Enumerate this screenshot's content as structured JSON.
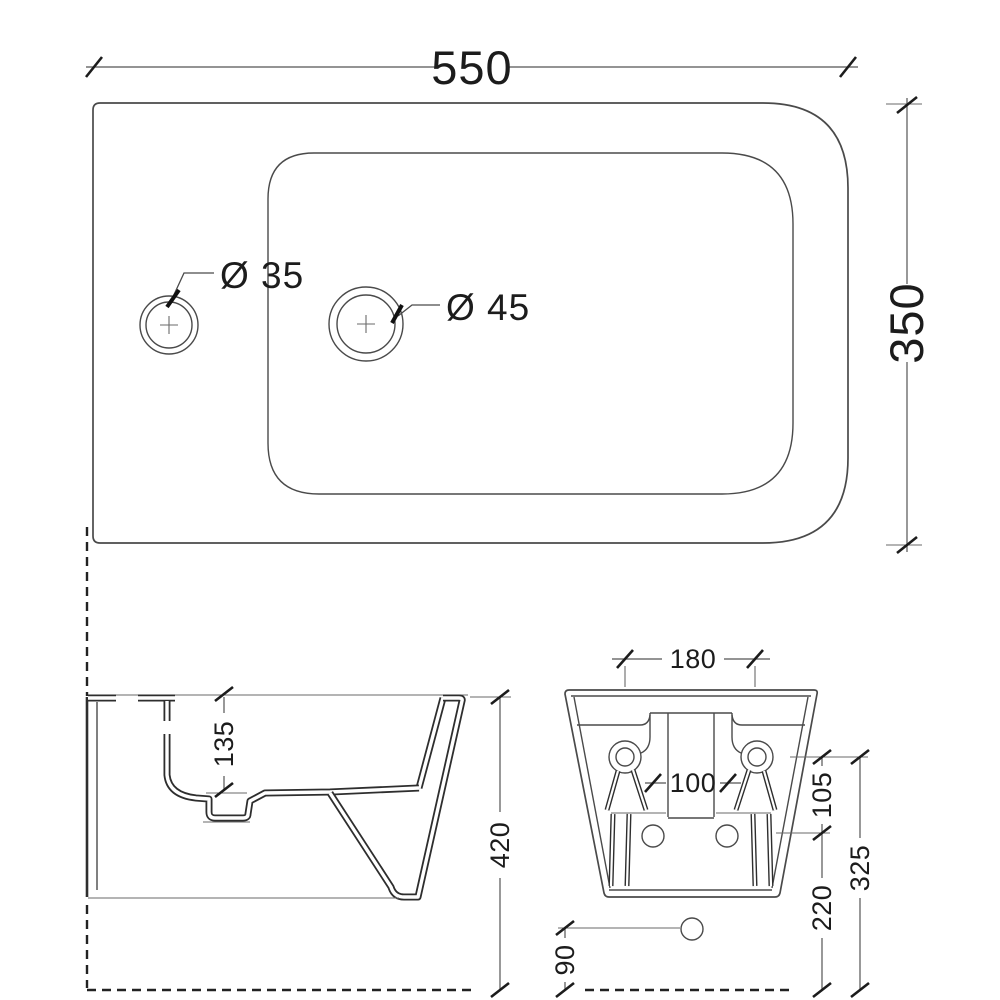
{
  "drawing": {
    "views": {
      "top": {
        "width": "550",
        "depth": "350",
        "faucet_hole_diameter": "Ø 35",
        "drain_hole_diameter": "Ø 45"
      },
      "side": {
        "rim_to_basin_depth": "135",
        "total_height": "420"
      },
      "back": {
        "fixing_hole_spacing": "180",
        "inlet_hole_spacing": "100",
        "fixing_to_inlet": "105",
        "fixing_hole_height": "325",
        "inlet_hole_height": "220",
        "drain_hole_height": "90"
      }
    },
    "colors": {
      "background": "#ffffff",
      "object_line": "#4a4a4a",
      "dimension_line": "#555555",
      "text": "#1c1c1c"
    }
  }
}
